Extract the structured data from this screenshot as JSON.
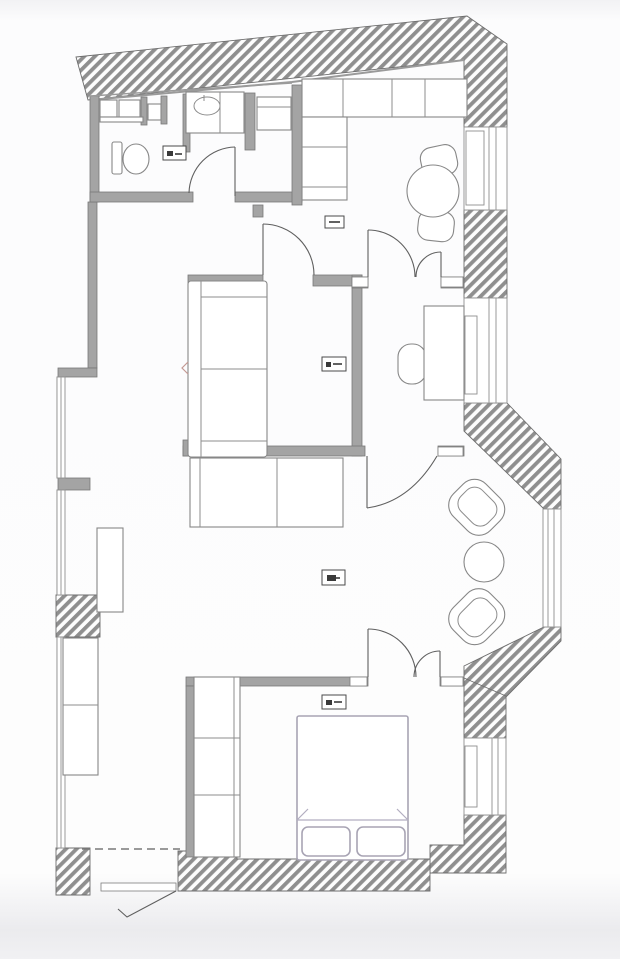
{
  "document": {
    "kind": "architectural floor plan",
    "style": "monochrome CAD line drawing, no readable text",
    "orientation": "portrait"
  },
  "palette": {
    "background": "#fdfdfd",
    "page_edge_tint": "#ededf0",
    "wall_fill": "#a4a4a4",
    "wall_edge": "#787878",
    "hatch_stripe": "#8f8f8f",
    "hatch_background": "#fdfdfd",
    "furniture_stroke": "#878787",
    "door_stroke": "#5f5f5f",
    "bed_stroke": "#a8a4b4",
    "tag_border": "#4a4a4a",
    "detail_mark": "#c49a94"
  },
  "plan": {
    "exterior_wall_style": "diagonal hatching (/)",
    "rooms": [
      {
        "id": "bathroom",
        "name": "bathroom",
        "furniture": [
          "washer-cabinets",
          "water-heater-box",
          "vanity-sink",
          "toilet"
        ]
      },
      {
        "id": "storage",
        "name": "storage-closet",
        "furniture": [
          "shelf-cabinet"
        ]
      },
      {
        "id": "kitchen",
        "name": "kitchen-dining",
        "furniture": [
          "l-shaped-counter",
          "round-dining-table",
          "dining-chair",
          "dining-chair"
        ]
      },
      {
        "id": "hallway",
        "name": "entry-hall",
        "furniture": [
          "low-cabinet",
          "radiator",
          "side-cabinet"
        ]
      },
      {
        "id": "living",
        "name": "living-room",
        "furniture": [
          "sofa"
        ]
      },
      {
        "id": "study",
        "name": "study-nook",
        "furniture": [
          "desk",
          "desk-chair"
        ]
      },
      {
        "id": "baynook",
        "name": "bay-window-nook",
        "furniture": [
          "armchair",
          "armchair",
          "round-side-table"
        ]
      },
      {
        "id": "bedroom",
        "name": "bedroom",
        "furniture": [
          "double-bed",
          "pillows",
          "wardrobe"
        ]
      }
    ],
    "area_tags": [
      {
        "room": "bathroom",
        "legible": false
      },
      {
        "room": "entry-hall",
        "legible": false
      },
      {
        "room": "living-room",
        "legible": false
      },
      {
        "room": "hallway-lower",
        "legible": false
      },
      {
        "room": "bedroom",
        "legible": false
      }
    ],
    "windows": [
      "left-wall-upper",
      "left-wall-lower",
      "kitchen-right",
      "study-right",
      "bay-right",
      "bedroom-right"
    ],
    "doors": [
      "entry-door-bottom",
      "bathroom-door",
      "living-room-door",
      "kitchen-double-door",
      "study-door",
      "bedroom-double-door"
    ]
  }
}
